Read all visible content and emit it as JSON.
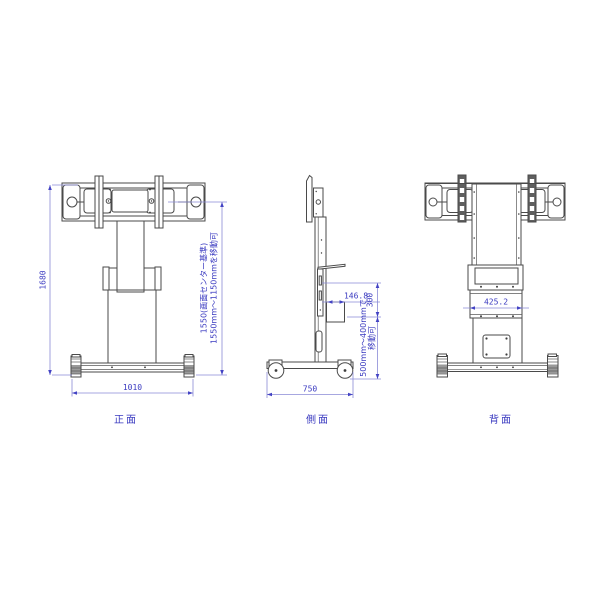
{
  "views": {
    "front": {
      "label": "正面",
      "dims": {
        "total_height": "1680",
        "base_width": "1010",
        "center_note_line1": "1550(画面センター基準)",
        "center_note_line2": "1550mm～1150mmを移動可"
      }
    },
    "side": {
      "label": "側面",
      "dims": {
        "base_depth": "750",
        "shelf_offset": "146.8",
        "shelf_drop": "300",
        "move_note_line1": "500mm～400mmで",
        "move_note_line2": "移動可"
      }
    },
    "back": {
      "label": "背面",
      "dims": {
        "panel_width": "425.2"
      }
    }
  },
  "colors": {
    "dimension_text": "#3a3ac0",
    "dimension_line": "#8a8ad6",
    "outline": "#4a4a4a",
    "background": "#ffffff"
  }
}
